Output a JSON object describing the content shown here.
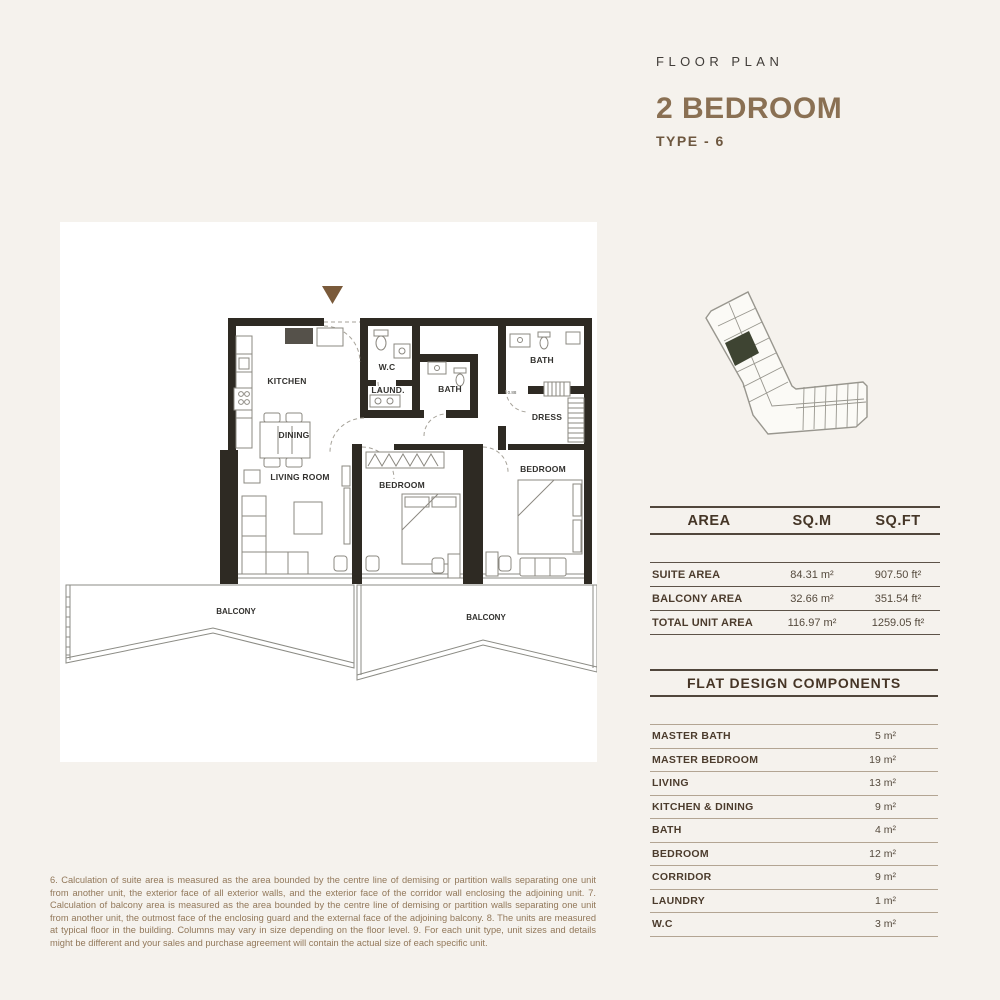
{
  "header": {
    "eyebrow": "FLOOR PLAN",
    "title": "2 BEDROOM",
    "subtitle": "TYPE - 6"
  },
  "plan": {
    "labels": {
      "kitchen": "KITCHEN",
      "dining": "DINING",
      "living": "LIVING ROOM",
      "wc": "W.C",
      "laundry": "LAUND.",
      "bath1": "BATH",
      "bath2": "BATH",
      "dress": "DRESS",
      "bedroom1": "BEDROOM",
      "bedroom2": "BEDROOM",
      "balcony1": "BALCONY",
      "balcony2": "BALCONY",
      "dim": "0.88"
    }
  },
  "area_table": {
    "headers": [
      "AREA",
      "SQ.M",
      "SQ.FT"
    ],
    "rows": [
      {
        "label": "SUITE AREA",
        "sqm": "84.31 m²",
        "sqft": "907.50 ft²"
      },
      {
        "label": "BALCONY AREA",
        "sqm": "32.66 m²",
        "sqft": "351.54 ft²"
      },
      {
        "label": "TOTAL UNIT AREA",
        "sqm": "116.97 m²",
        "sqft": "1259.05 ft²"
      }
    ]
  },
  "components_table": {
    "title": "FLAT DESIGN COMPONENTS",
    "rows": [
      {
        "label": "MASTER BATH",
        "value": "5 m²"
      },
      {
        "label": "MASTER BEDROOM",
        "value": "19 m²"
      },
      {
        "label": "LIVING",
        "value": "13 m²"
      },
      {
        "label": "KITCHEN & DINING",
        "value": "9 m²"
      },
      {
        "label": "BATH",
        "value": "4 m²"
      },
      {
        "label": "BEDROOM",
        "value": "12 m²"
      },
      {
        "label": "CORRIDOR",
        "value": "9 m²"
      },
      {
        "label": "LAUNDRY",
        "value": "1 m²"
      },
      {
        "label": "W.C",
        "value": "3 m²"
      }
    ]
  },
  "footnote": "6. Calculation of suite area is measured as the area bounded by the centre line of demising or partition walls separating one unit from another unit, the exterior face of all exterior walls, and the exterior face of the corridor wall enclosing the adjoining unit.  7. Calculation of balcony area is measured as the area bounded by the centre line of demising or partition walls separating one unit from another unit, the outmost face of the enclosing guard and the external face of the adjoining balcony. 8. The units are measured at typical floor in the building. Columns may vary in size depending on the floor level. 9. For each unit type, unit sizes and details might be different and your sales and purchase agreement will contain the actual size of each specific unit.",
  "colors": {
    "background": "#f5f2ed",
    "wall": "#2e2a23",
    "accent_brown": "#8a7053",
    "marker_brown": "#7a5a3a",
    "highlight_unit": "#3e4432",
    "footnote_brown": "#92785a"
  }
}
